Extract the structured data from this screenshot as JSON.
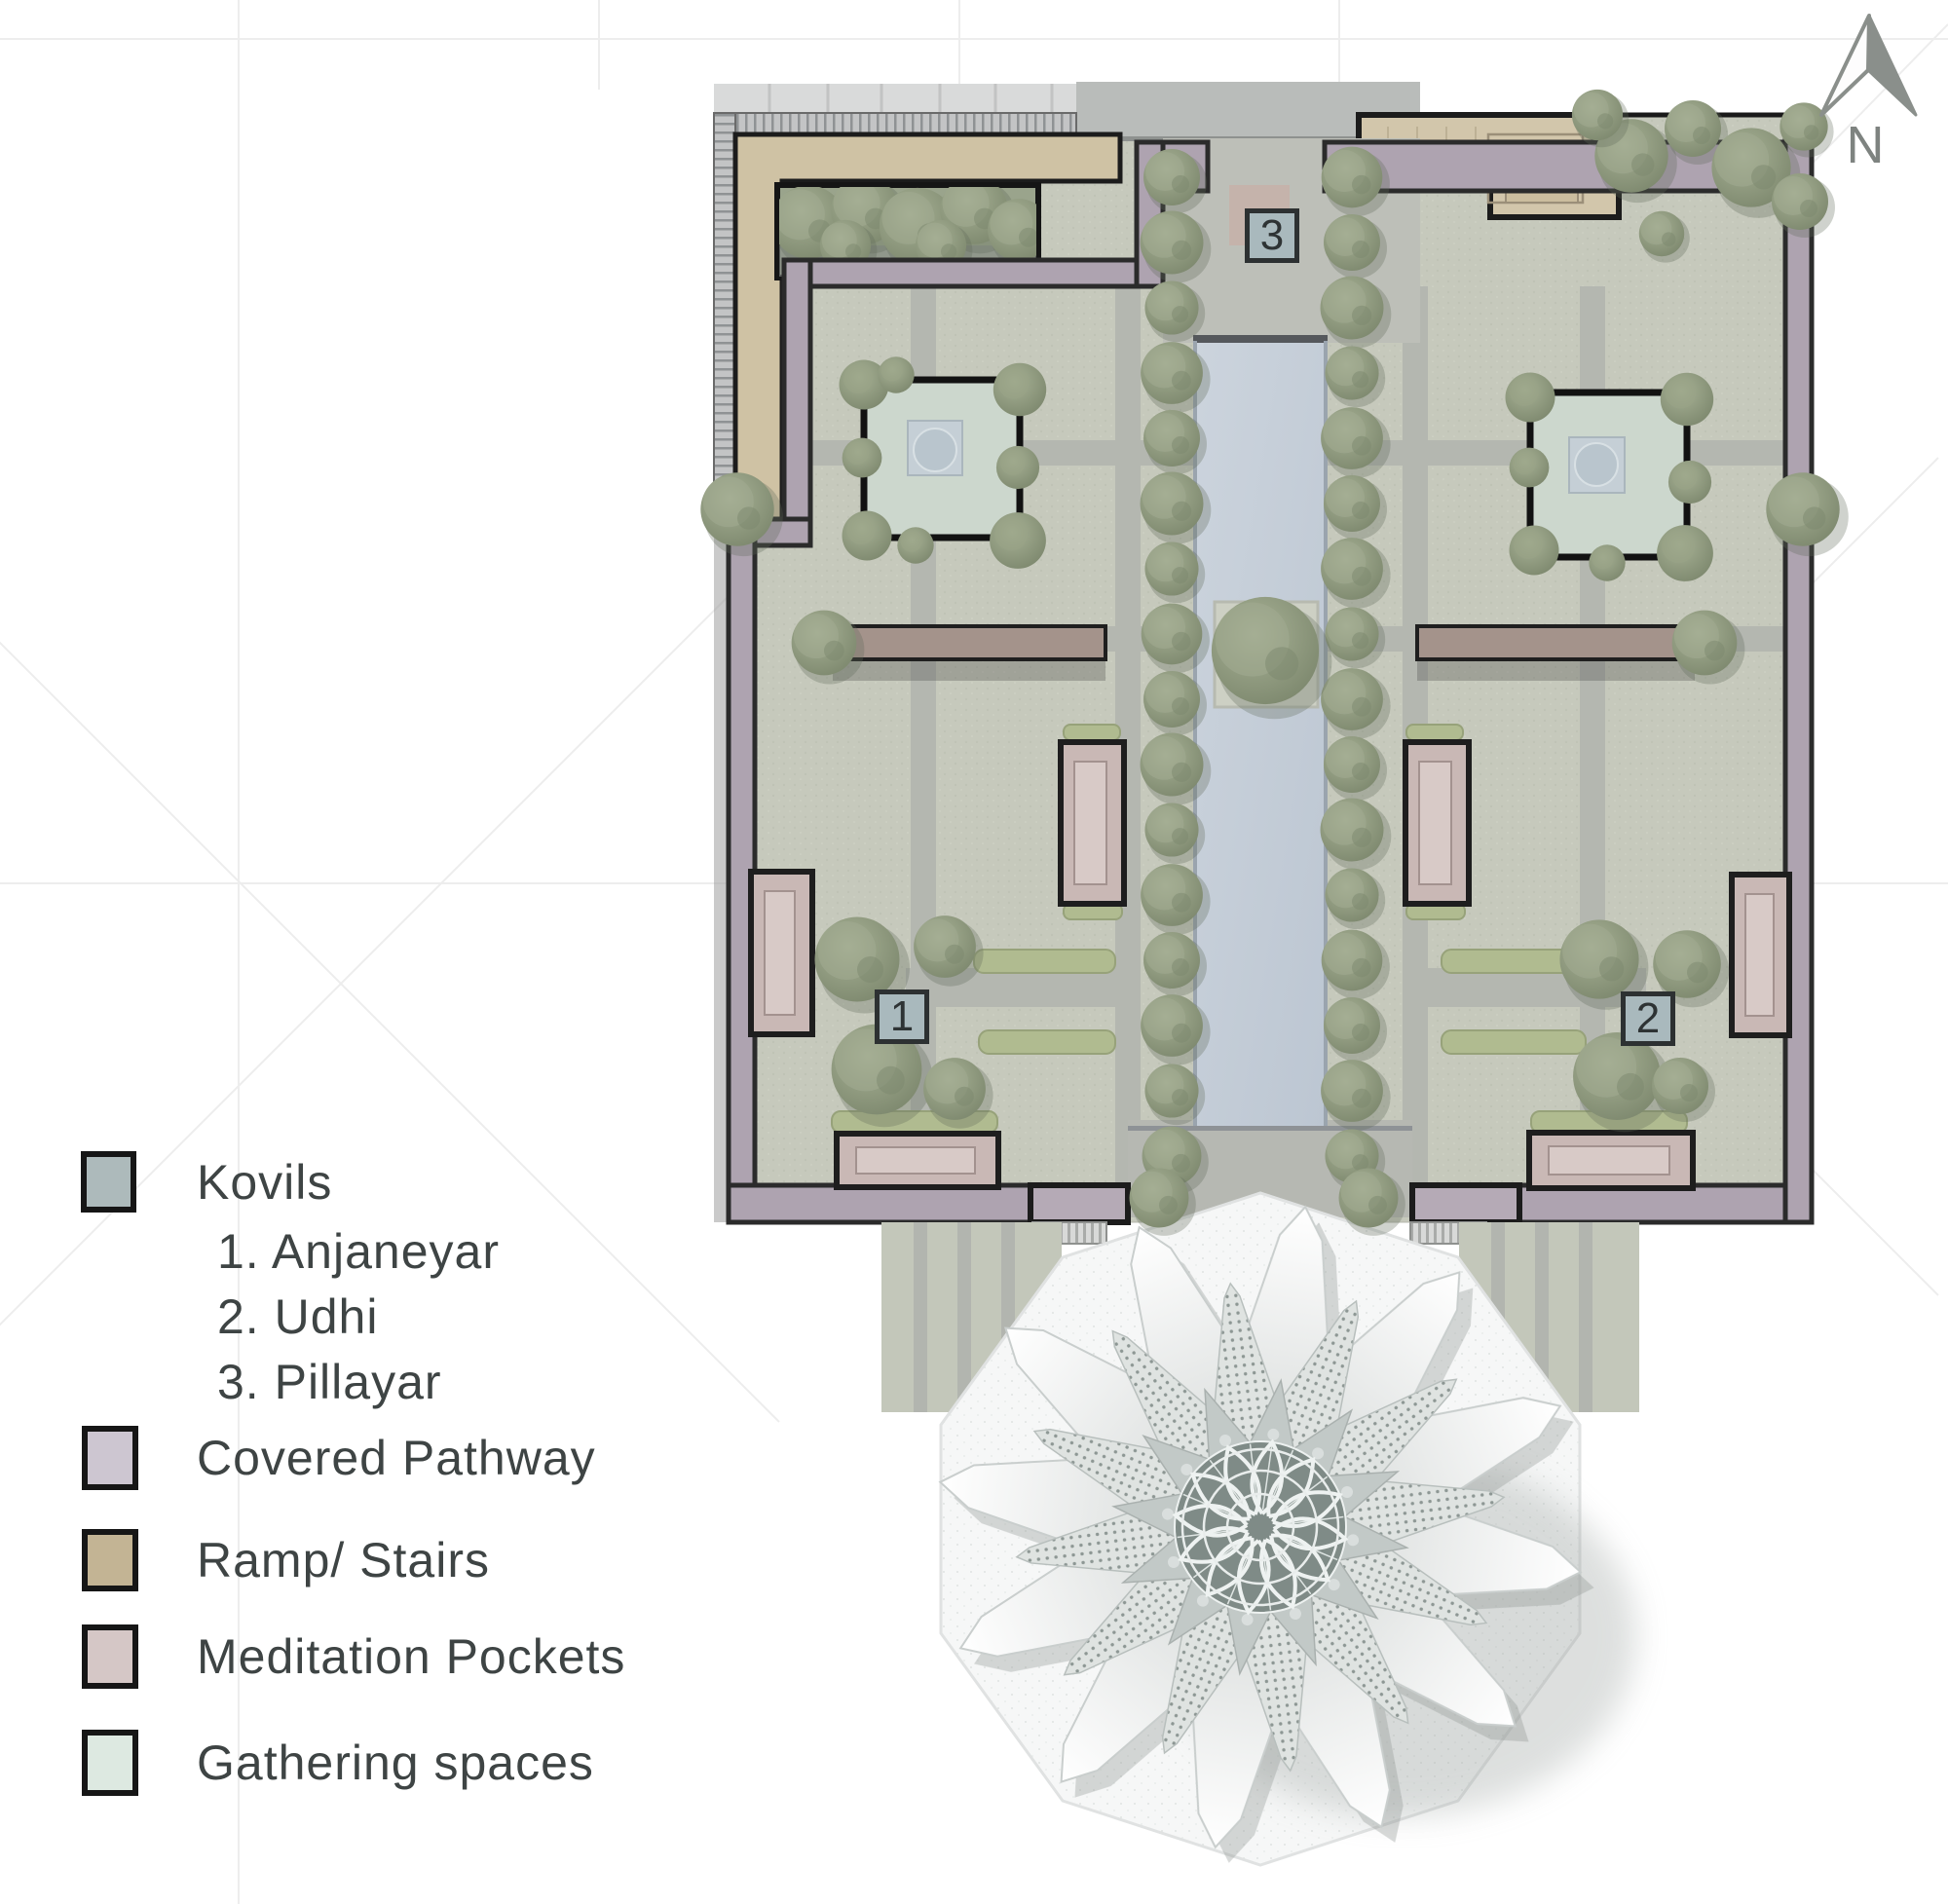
{
  "north": {
    "label": "N"
  },
  "legend": {
    "kovils": {
      "label": "Kovils",
      "swatch_color": "#adbabb",
      "items": [
        "1. Anjaneyar",
        "2. Udhi",
        "3. Pillayar"
      ]
    },
    "entries": [
      {
        "label": "Covered Pathway",
        "swatch_color": "#cdc6d1"
      },
      {
        "label": "Ramp/ Stairs",
        "swatch_color": "#c3b494"
      },
      {
        "label": "Meditation Pockets",
        "swatch_color": "#d5c7c6"
      },
      {
        "label": "Gathering spaces",
        "swatch_color": "#dde9e1"
      }
    ]
  },
  "markers": [
    {
      "num": "1"
    },
    {
      "num": "2"
    },
    {
      "num": "3"
    }
  ],
  "palette": {
    "kovil_marker": "#a9b9bd",
    "lawn": "#c6c9bc",
    "path": "#b4b7b0",
    "water": "#c3ccd6",
    "covered_pathway": "#aea3b0",
    "ramp_stairs": "#cfc2a4",
    "meditation_pocket": "#c9b8b5",
    "gathering_space": "#ccd7cd",
    "tree": "#8e9a85",
    "hedge": "#b0bb90",
    "outline": "#1c1c1c",
    "plaza": "#f6f7f7"
  }
}
